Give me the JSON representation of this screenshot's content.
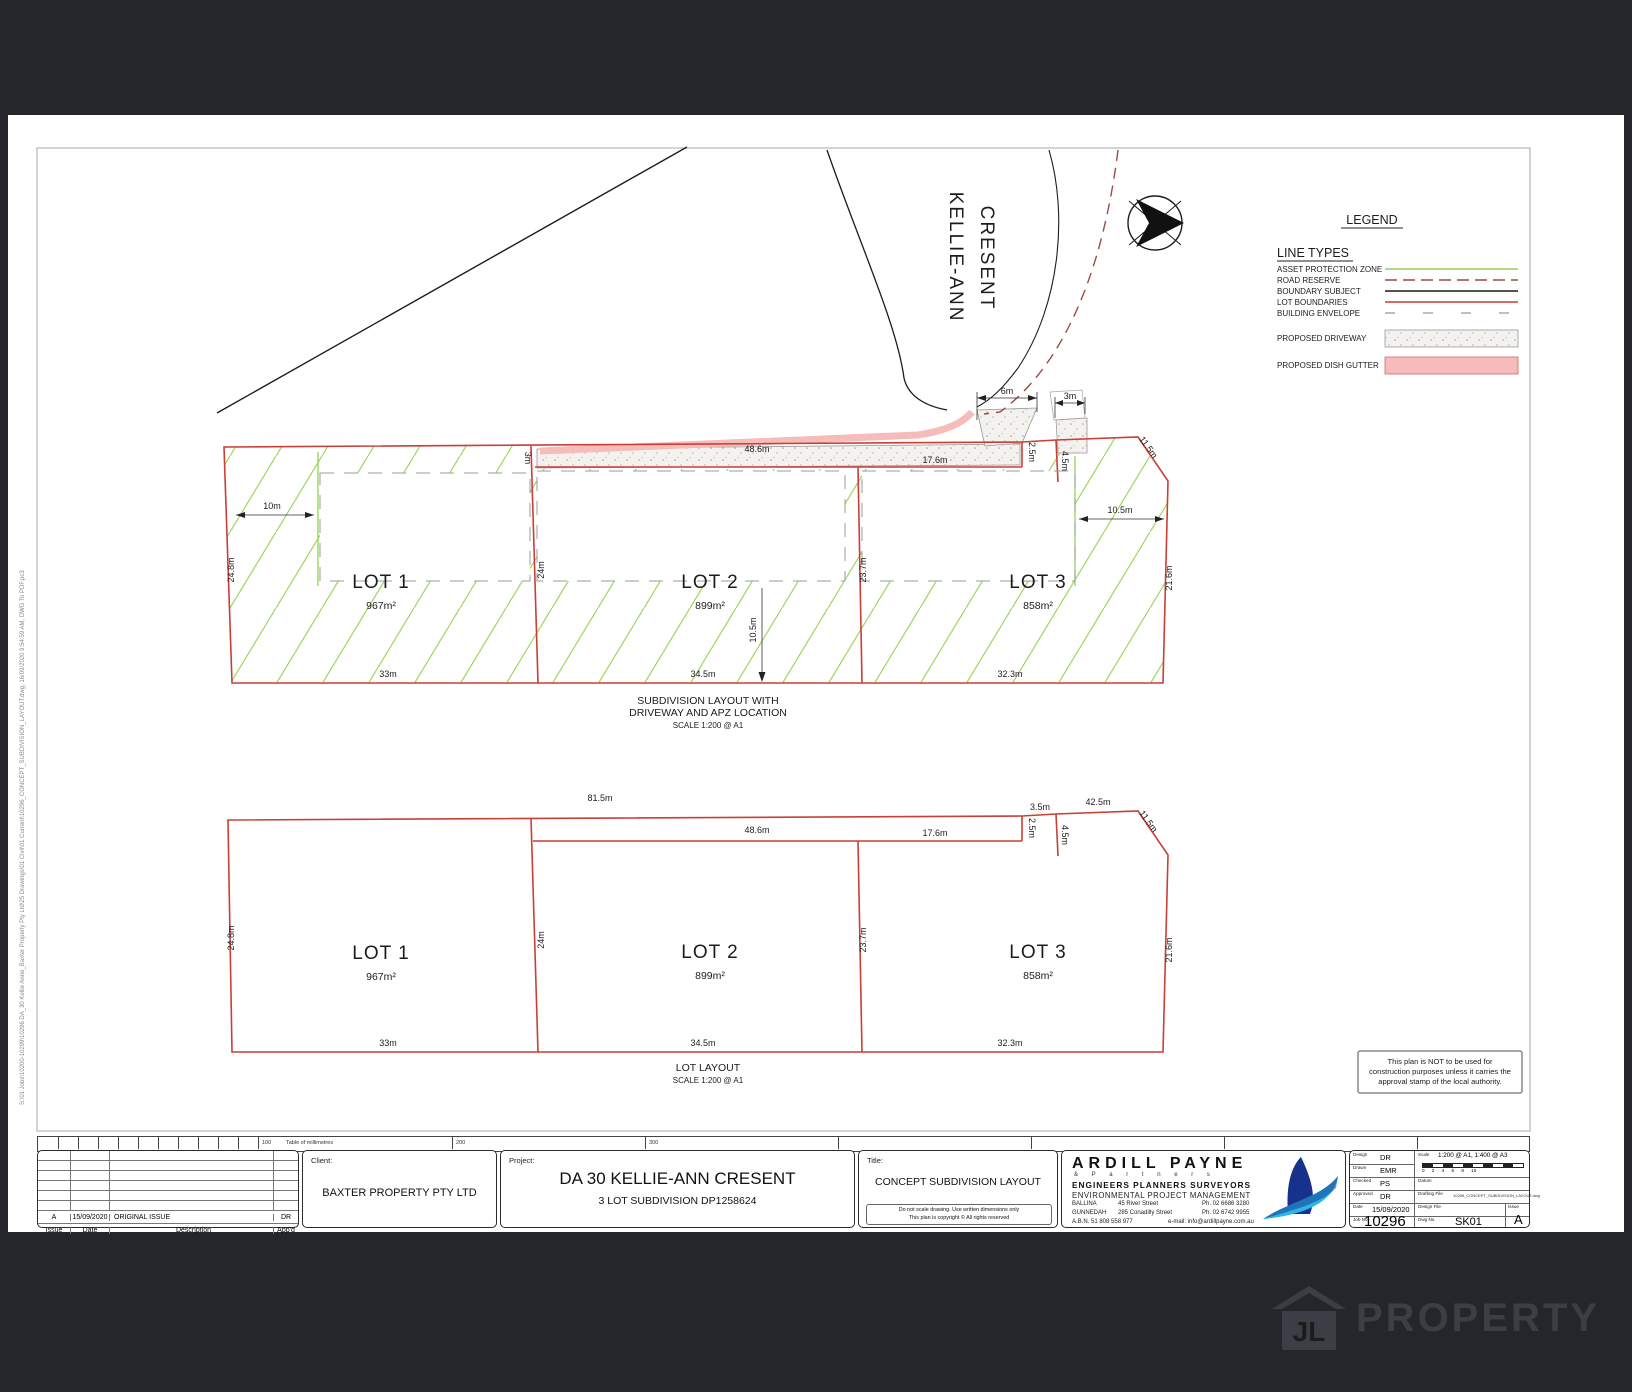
{
  "street": {
    "line1": "KELLIE-ANN",
    "line2": "CRESENT"
  },
  "legend": {
    "title": "LEGEND",
    "section": "LINE TYPES",
    "line_types": [
      {
        "label": "ASSET PROTECTION ZONE"
      },
      {
        "label": "ROAD RESERVE"
      },
      {
        "label": "BOUNDARY SUBJECT"
      },
      {
        "label": "LOT BOUNDARIES"
      },
      {
        "label": "BUILDING ENVELOPE"
      }
    ],
    "driveway_label": "PROPOSED DRIVEWAY",
    "gutter_label": "PROPOSED DISH GUTTER"
  },
  "plan_top": {
    "caption_line1": "SUBDIVISION LAYOUT WITH",
    "caption_line2": "DRIVEWAY AND APZ LOCATION",
    "caption_scale": "SCALE 1:200 @ A1",
    "lots": [
      {
        "name": "LOT 1",
        "area": "967m²"
      },
      {
        "name": "LOT 2",
        "area": "899m²"
      },
      {
        "name": "LOT 3",
        "area": "858m²"
      }
    ],
    "dims": {
      "entry_width": "6m",
      "lot3_drive_width": "3m",
      "handle_width": "2.5m",
      "lot3_drive_len": "4.5m",
      "drive_len": "48.6m",
      "lot3_top": "17.6m",
      "splay": "11.5m",
      "drive_width_left": "3m",
      "apz_left": "10m",
      "apz_right": "10.5m",
      "left_side": "24.8m",
      "div1": "24m",
      "div2": "23.7m",
      "right_side": "21.6m",
      "apz_bottom": "10.5m",
      "bottom1": "33m",
      "bottom2": "34.5m",
      "bottom3": "32.3m"
    }
  },
  "plan_bottom": {
    "caption_line1": "LOT LAYOUT",
    "caption_scale": "SCALE 1:200 @ A1",
    "lots": [
      {
        "name": "LOT 1",
        "area": "967m²"
      },
      {
        "name": "LOT 2",
        "area": "899m²"
      },
      {
        "name": "LOT 3",
        "area": "858m²"
      }
    ],
    "dims": {
      "top_total": "81.5m",
      "handle_len": "48.6m",
      "lot3_top": "17.6m",
      "notch": "3.5m",
      "top_right": "42.5m",
      "handle_width": "2.5m",
      "lot3_drive_len": "4.5m",
      "splay": "11.5m",
      "left_side": "24.8m",
      "div1": "24m",
      "div2": "23.7m",
      "right_side": "21.6m",
      "bottom1": "33m",
      "bottom2": "34.5m",
      "bottom3": "32.3m"
    }
  },
  "note_box": {
    "line1": "This plan is NOT to be used for",
    "line2": "construction purposes unless it carries the",
    "line3": "approval stamp of the local authority."
  },
  "ruler": {
    "n100": "100",
    "caption": "Table of millimetres",
    "n200": "200",
    "n300": "300"
  },
  "sidebar_path": "S:\\01 Jobs\\10200-10299\\10296 DA_30 Kellie Anne_Baxter Property Pty Ltd\\25 Drawings\\01 Civil\\01 Current\\10296_CONCEPT_SUBDIVISION_LAYOUT.dwg, 16/09/2020 9:54:59 AM, DWG To PDF.pc3",
  "title_block": {
    "revision": {
      "columns": [
        "Issue",
        "Date",
        "Description",
        "App'd"
      ],
      "rows": [
        {
          "issue": "A",
          "date": "15/09/2020",
          "description": "ORIGINAL ISSUE",
          "appd": "DR"
        }
      ]
    },
    "client_label": "Client:",
    "client": "BAXTER PROPERTY PTY LTD",
    "project_label": "Project:",
    "project_line1": "DA 30 KELLIE-ANN CRESENT",
    "project_line2": "3 LOT SUBDIVISION DP1258624",
    "title_label": "Title:",
    "title": "CONCEPT SUBDIVISION LAYOUT",
    "disclaimer_line1": "Do not scale drawing. Use written dimensions only",
    "disclaimer_line2": "This plan is copyright © All rights reserved",
    "firm": {
      "name": "ARDILL PAYNE",
      "partners": "& P a r t n e r s",
      "line1": "ENGINEERS  PLANNERS  SURVEYORS",
      "line2": "ENVIRONMENTAL   PROJECT MANAGEMENT",
      "office1": {
        "city": "BALLINA",
        "address": "45 River Street",
        "phone": "Ph. 02 6686 3280"
      },
      "office2": {
        "city": "GUNNEDAH",
        "address": "285 Conadilly Street",
        "phone": "Ph. 02 6742 9955"
      },
      "abn": "A.B.N. 51 808 558 977",
      "email": "e-mail: info@ardillpayne.com.au"
    },
    "fields": {
      "design_label": "Design",
      "design": "DR",
      "drawn_label": "Drawn",
      "drawn": "EMR",
      "checked_label": "Checked",
      "checked": "PS",
      "approved_label": "Approved",
      "approved": "DR",
      "date_label": "Date",
      "date": "15/09/2020",
      "job_label": "Job No.",
      "job": "10296",
      "scale_label": "Scale",
      "scale": "1:200 @ A1, 1:400 @ A3",
      "scalebar_ticks": "0   2   4   6   8   10",
      "datum_label": "Datum",
      "drafting_label": "Drafting File",
      "drafting": "10296_CONCEPT_SUBDIVISION_LAYOUT.dwg",
      "designfile_label": "Design File",
      "dwg_label": "Dwg No.",
      "dwg": "SK01",
      "issue_label": "Issue",
      "issue": "A"
    }
  },
  "watermark": {
    "monogram": "JL",
    "text": "PROPERTY"
  }
}
